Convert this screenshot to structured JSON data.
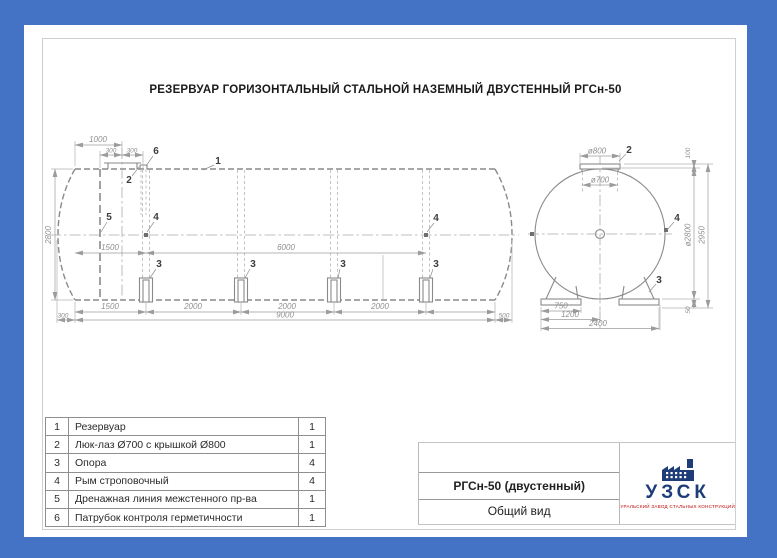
{
  "title": "РЕЗЕРВУАР ГОРИЗОНТАЛЬНЫЙ СТАЛЬНОЙ НАЗЕМНЫЙ ДВУСТЕННЫЙ РГСн-50",
  "side_view": {
    "dim_1000": "1000",
    "dim_300a": "300",
    "dim_300b": "300",
    "dim_2800": "2800",
    "dim_1500_mid": "1500",
    "dim_6000": "6000",
    "dim_1500_bot": "1500",
    "dim_2000a": "2000",
    "dim_2000b": "2000",
    "dim_2000c": "2000",
    "dim_9000": "9000",
    "dim_300_left": "300",
    "dim_500_right": "500",
    "callout_1": "1",
    "callout_2": "2",
    "callout_3": "3",
    "callout_4": "4",
    "callout_5": "5",
    "callout_6": "6"
  },
  "end_view": {
    "dim_d800": "ø800",
    "dim_d700": "ø700",
    "dim_100": "100",
    "dim_d2800": "ø2800",
    "dim_2950": "2950",
    "dim_50": "50",
    "dim_750": "750",
    "dim_1200": "1200",
    "dim_2400": "2400",
    "callout_2": "2",
    "callout_3": "3",
    "callout_4": "4"
  },
  "parts_table": {
    "rows": [
      {
        "num": "1",
        "name": "Резервуар",
        "qty": "1"
      },
      {
        "num": "2",
        "name": "Люк-лаз Ø700 с крышкой Ø800",
        "qty": "1"
      },
      {
        "num": "3",
        "name": "Опора",
        "qty": "4"
      },
      {
        "num": "4",
        "name": "Рым строповочный",
        "qty": "4"
      },
      {
        "num": "5",
        "name": "Дренажная линия межстенного пр-ва",
        "qty": "1"
      },
      {
        "num": "6",
        "name": "Патрубок контроля герметичности",
        "qty": "1"
      }
    ]
  },
  "title_block": {
    "model": "РГСн-50 (двустенный)",
    "view_name": "Общий вид"
  },
  "logo": {
    "abbr": "УЗСК",
    "caption": "УРАЛЬСКИЙ ЗАВОД СТАЛЬНЫХ КОНСТРУКЦИЙ"
  },
  "colors": {
    "frame_blue": "#4472C4",
    "logo_blue": "#1d3c78",
    "logo_red": "#c00000"
  }
}
